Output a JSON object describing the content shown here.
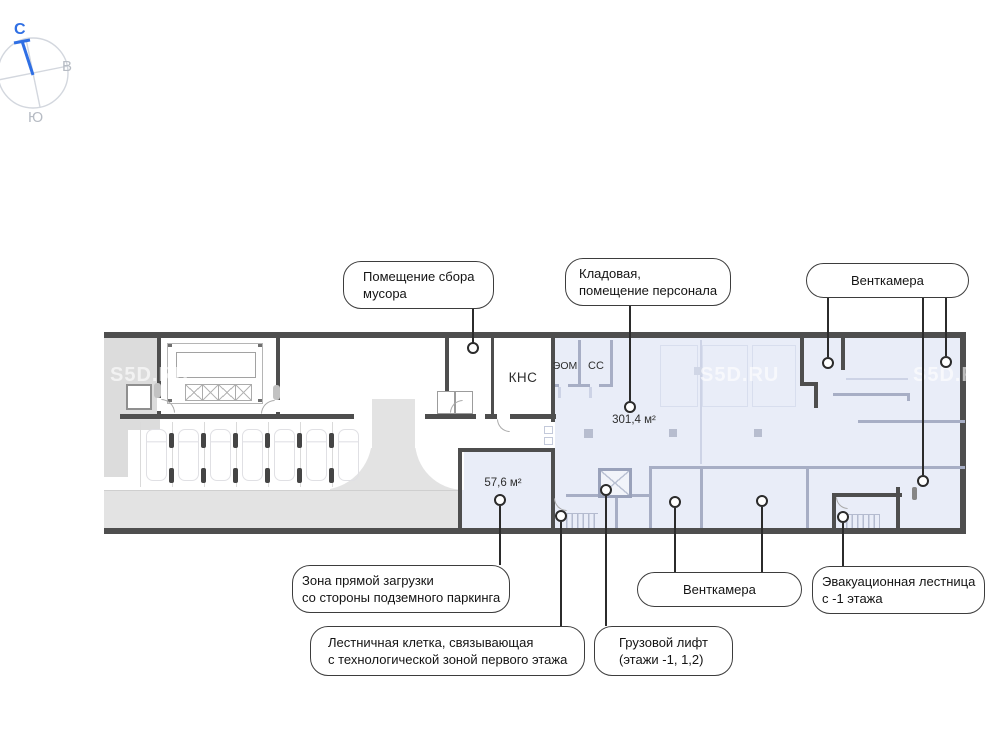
{
  "compass": {
    "north": "С",
    "east": "В",
    "south": "Ю"
  },
  "watermark": "S5D.RU",
  "plan": {
    "kns": "КНС",
    "eom": "ЭОМ",
    "ss": "СС",
    "area_main": "301,4 м²",
    "area_loading": "57,6 м²"
  },
  "callouts": {
    "trash": {
      "line1": "Помещение сбора",
      "line2": "мусора"
    },
    "storage": {
      "line1": "Кладовая,",
      "line2": "помещение персонала"
    },
    "vent_top": {
      "line1": "Венткамера"
    },
    "loading": {
      "line1": "Зона прямой загрузки",
      "line2": "со стороны подземного паркинга"
    },
    "vent_bottom": {
      "line1": "Венткамера"
    },
    "evac": {
      "line1": "Эвакуационная лестница",
      "line2": "с -1 этажа"
    },
    "stair": {
      "line1": "Лестничная клетка, связывающая",
      "line2": "с технологической зоной первого этажа"
    },
    "lift": {
      "line1": "Грузовой лифт",
      "line2": "(этажи -1, 1,2)"
    }
  },
  "colors": {
    "accent_blue": "#2f6fe4",
    "zone_fill": "#e9edf8",
    "road_fill": "#e3e3e3",
    "wall_dark": "#4e4e4e",
    "wall_interior": "#a7aec5"
  }
}
